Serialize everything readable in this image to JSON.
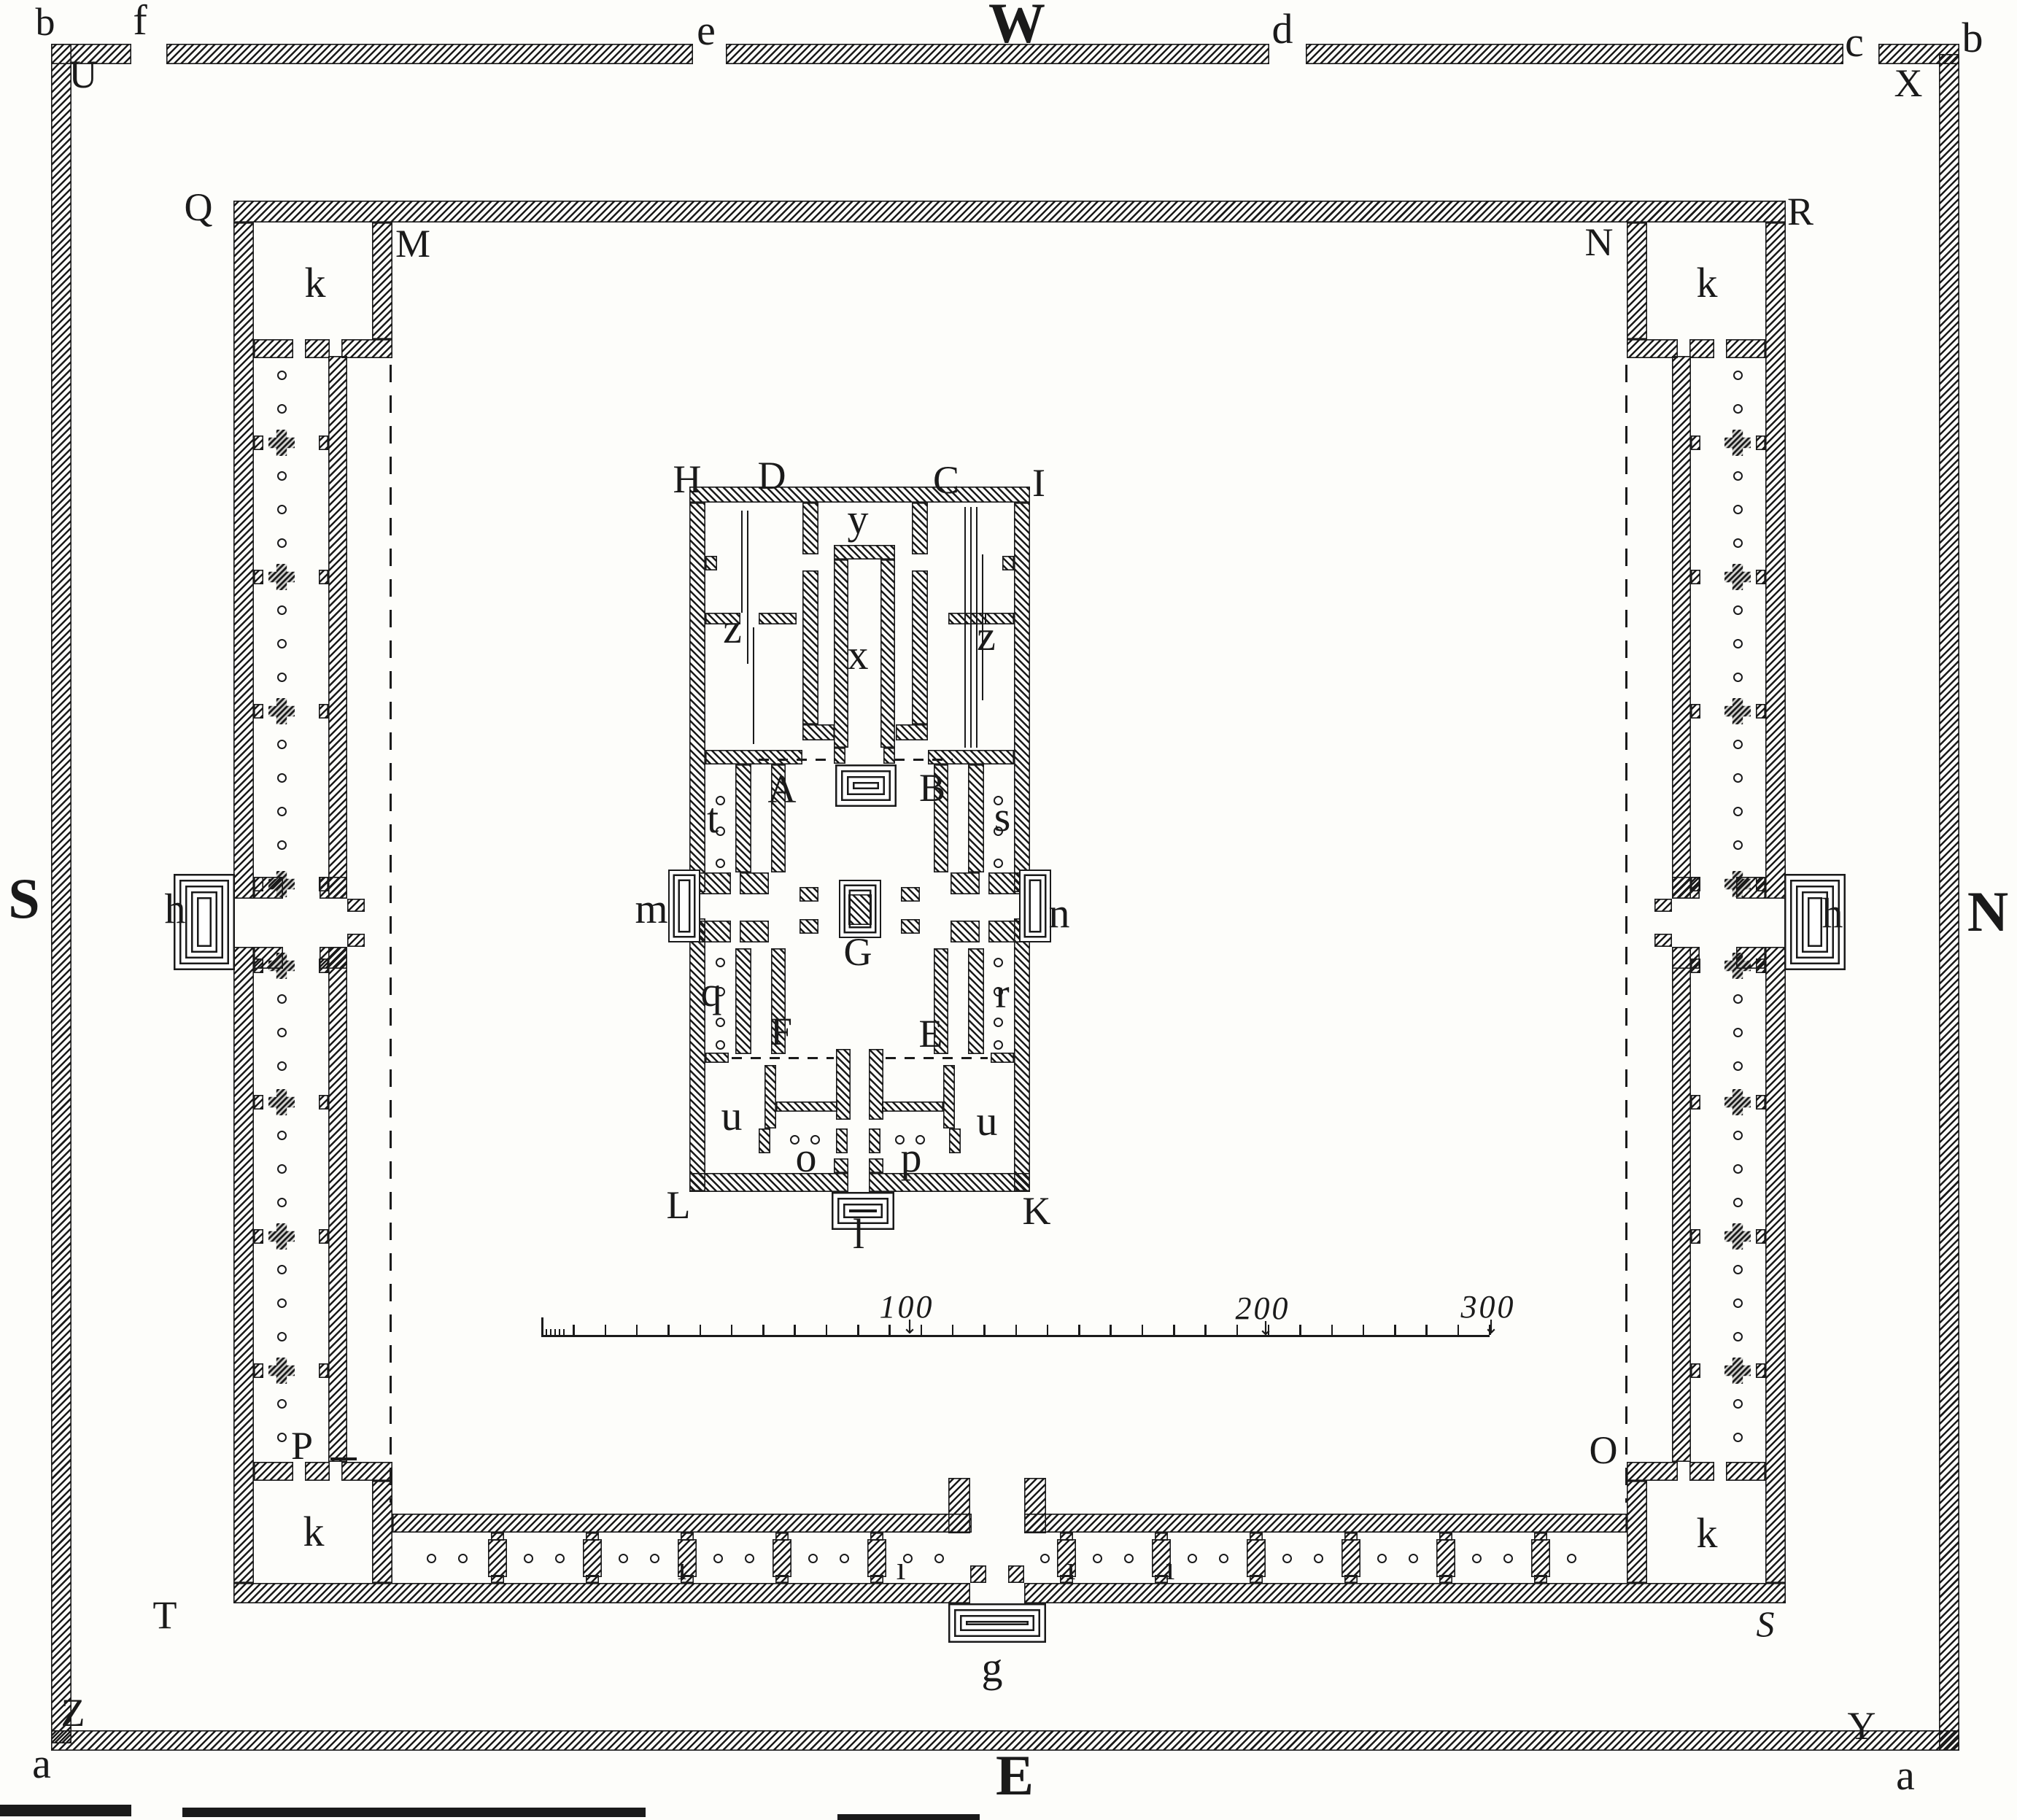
{
  "figure": {
    "kind": "engraved architectural ground plan",
    "orientation_note": "compass letters W top, E bottom, S left, N right"
  },
  "palette": {
    "ink": "#1a1a1a",
    "paper": "#fdfdfa"
  },
  "labels": {
    "b_tl": "b",
    "f": "f",
    "e": "e",
    "W": "W",
    "d": "d",
    "c": "c",
    "b_tr": "b",
    "U": "U",
    "X": "X",
    "S_compass": "S",
    "N_compass": "N",
    "E_compass": "E",
    "Z": "Z",
    "Y": "Y",
    "a_bl": "a",
    "a_br": "a",
    "Q": "Q",
    "M": "M",
    "N_wall": "N",
    "R": "R",
    "P": "P",
    "T": "T",
    "O": "O",
    "S_wall": "S",
    "k_tl": "k",
    "k_tr": "k",
    "k_bl": "k",
    "k_br": "k",
    "h_left": "h",
    "h_right": "h",
    "g": "g",
    "i1": "ı",
    "i2": "ı",
    "i3": "ı",
    "i4": "ı",
    "H": "H",
    "D": "D",
    "C": "C",
    "I": "I",
    "y": "y",
    "x": "x",
    "z_left": "z",
    "z_right": "z",
    "A": "A",
    "B": "B",
    "m": "m",
    "n": "n",
    "t": "t",
    "s": "s",
    "q": "q",
    "r": "r",
    "G": "G",
    "F": "F",
    "E_court": "E",
    "u_left": "u",
    "u_right": "u",
    "o": "o",
    "p": "p",
    "L": "L",
    "K": "K",
    "l": "l",
    "scale_100": "100",
    "scale_200": "200",
    "scale_300": "300"
  },
  "icons": {
    "down_arrow": "↓"
  }
}
